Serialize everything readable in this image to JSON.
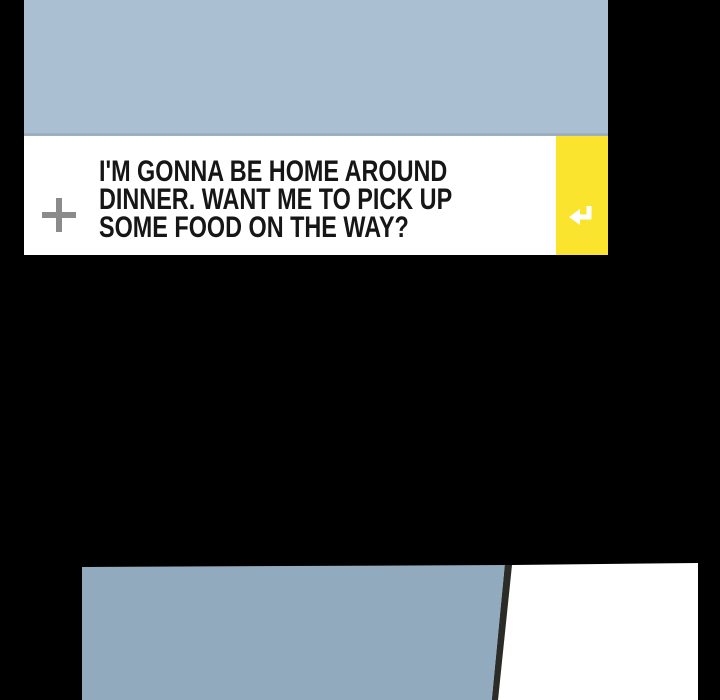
{
  "canvas": {
    "width": 720,
    "height": 700,
    "background_color": "#000000"
  },
  "top_panel": {
    "artwork": {
      "name": "blue-gray-scene",
      "color": "#ABBFD2",
      "bottom_edge_color": "#9EAFC0"
    },
    "message_bar": {
      "background_color": "#FFFFFF",
      "plus_icon": {
        "glyph": "+",
        "color": "#8B8B8B"
      },
      "text_color": "#161616",
      "text_lines": [
        "I'M GONNA BE HOME AROUND",
        "DINNER. WANT ME TO PICK UP",
        "SOME FOOD ON THE WAY?"
      ],
      "full_text": "I'M GONNA BE HOME AROUND DINNER. WANT ME TO PICK UP SOME FOOD ON THE WAY?",
      "send_button": {
        "background_color": "#FBE42D",
        "icon": "return-arrow",
        "icon_color": "#FFFFFF"
      }
    }
  },
  "bottom_panel": {
    "wall_color": "#92AABD",
    "frame_color": "#2B2B28",
    "door_color": "#FFFFFF"
  }
}
